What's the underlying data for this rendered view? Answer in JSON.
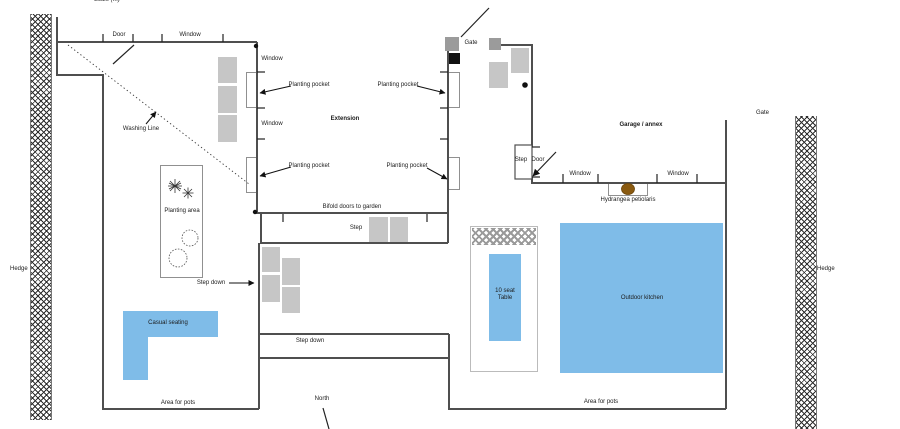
{
  "scale_label": "Scale (m)",
  "boundary": {
    "hedge_left": "Hedge",
    "hedge_right": "Hedge",
    "gate_top": "Gate",
    "gate_right": "Gate",
    "north": "North"
  },
  "house": {
    "door": "Door",
    "window_top": "Window",
    "window_left_1": "Window",
    "window_left_2": "Window",
    "extension": "Extension",
    "planting_pocket": "Planting pocket",
    "washing_line": "Washing Line",
    "bifold": "Bifold doors to garden",
    "step": "Step"
  },
  "garage": {
    "name": "Garage / annex",
    "step": "Step",
    "door": "Door",
    "window_1": "Window",
    "window_2": "Window",
    "hydrangea": "Hydrangea petiolaris"
  },
  "garden": {
    "planting_area": "Planting area",
    "step_down_left": "Step down",
    "step_down_band": "Step down",
    "casual_seating": "Casual seating",
    "area_for_pots_left": "Area for pots",
    "area_for_pots_right": "Area for pots",
    "table_line1": "10 seat",
    "table_line2": "Table",
    "outdoor_kitchen": "Outdoor kitchen"
  },
  "colors": {
    "wall": "#4f4f4f",
    "paving": "#c6c6c6",
    "water_blue": "#7fbce8",
    "hydrangea_brown": "#8a5a10"
  }
}
